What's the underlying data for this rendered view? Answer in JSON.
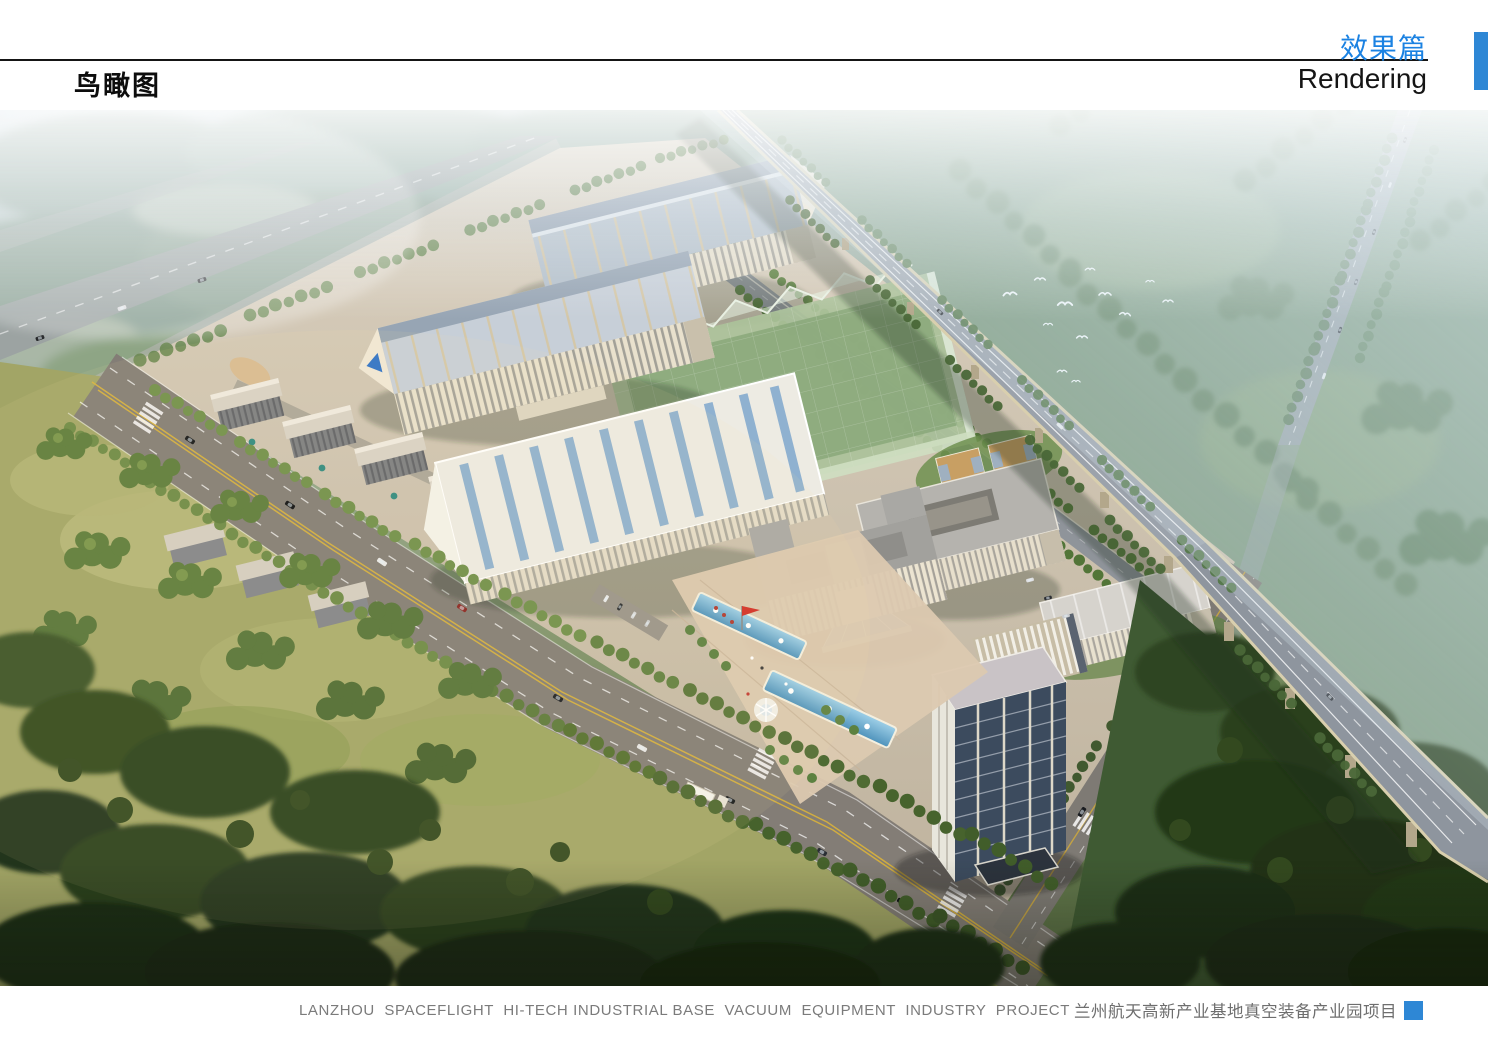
{
  "header": {
    "page_title": "鸟瞰图",
    "section_title_zh": "效果篇",
    "section_title_en": "Rendering"
  },
  "footer": {
    "caption_en": "LANZHOU  SPACEFLIGHT  HI-TECH INDUSTRIAL BASE  VACUUM  EQUIPMENT  INDUSTRY  PROJECT",
    "caption_zh": "兰州航天高新产业基地真空装备产业园项目"
  },
  "rendering": {
    "subject": "aerial bird's-eye rendering of an industrial park with factory halls, office buildings, plaza with fountain pools, elevated highway viaduct, roads and forests"
  },
  "palette": {
    "accent_blue": "#1b82e2",
    "accent_bar": "#2e87d5",
    "title_ink": "#151515",
    "caption_grey": "#7b7b7b",
    "sky_haze": "#c9d8e1",
    "distant_green": "#8ba399",
    "meadow": "#a2a566",
    "tree_green": "#5d7c3b",
    "forest_dark": "#2b401f",
    "road_grey": "#8a857d",
    "campus_ground": "#cfc5b2",
    "factory_wall": "#e9e1cd",
    "factory_roof": "#b3bfca",
    "glass_green": "#abc29a",
    "roof_white": "#edebe3",
    "skylight_blue": "#7fa7cd",
    "pool_blue": "#5fa8cf",
    "tower_glass": "#3c4b5e",
    "viaduct_deck": "#8e959e",
    "viaduct_edge": "#d9cfae",
    "logo_blue": "#2e72c8",
    "flag_red": "#d22f27",
    "lane_yellow": "#d9b33c"
  }
}
